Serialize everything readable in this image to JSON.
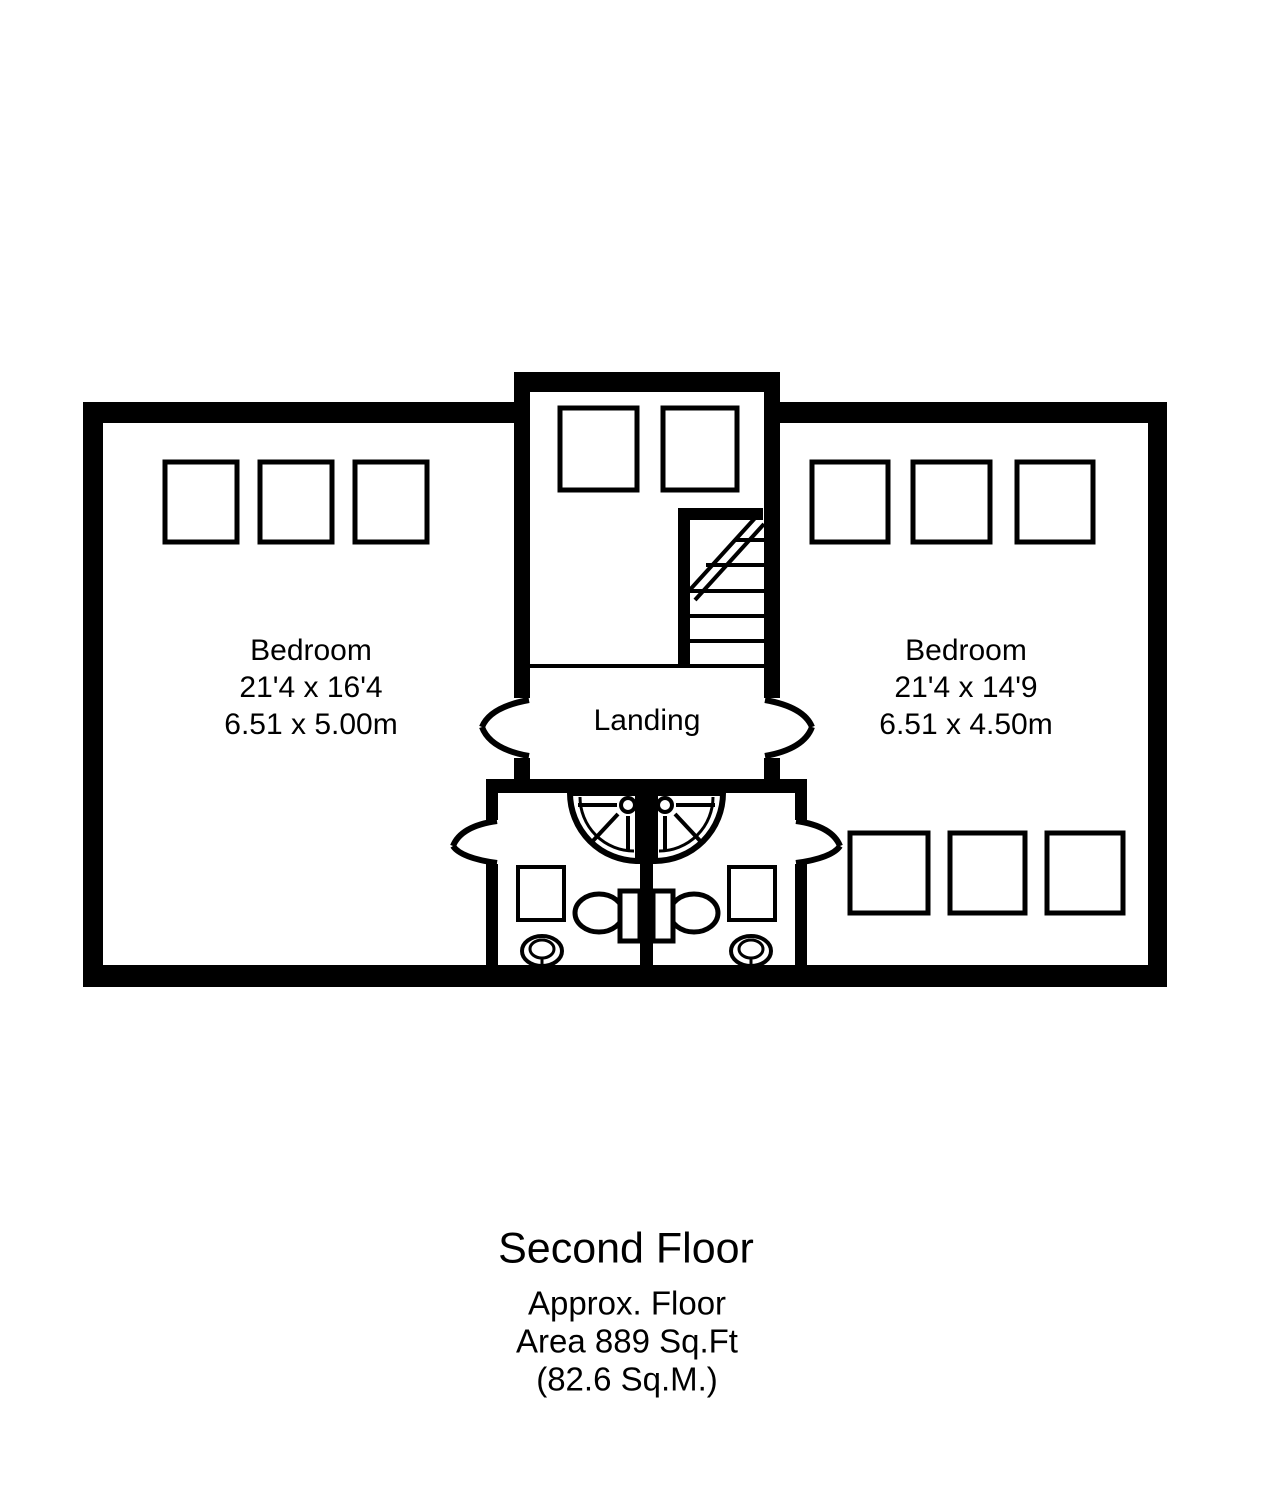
{
  "canvas": {
    "background": "#ffffff",
    "line_color": "#000000"
  },
  "floorplan": {
    "rooms": [
      {
        "name": "Bedroom",
        "dims_imperial": "21'4 x 16'4",
        "dims_metric": "6.51 x 5.00m"
      },
      {
        "name": "Bedroom",
        "dims_imperial": "21'4 x 14'9",
        "dims_metric": "6.51 x 4.50m"
      },
      {
        "name": "Landing"
      }
    ],
    "fixtures": [
      "staircase",
      "shower-left",
      "shower-right",
      "toilet-left",
      "toilet-right",
      "basin-left",
      "basin-right"
    ]
  },
  "caption": {
    "floor": "Second Floor",
    "line1": "Approx. Floor",
    "line2": "Area 889 Sq.Ft",
    "line3": "(82.6 Sq.M.)"
  }
}
